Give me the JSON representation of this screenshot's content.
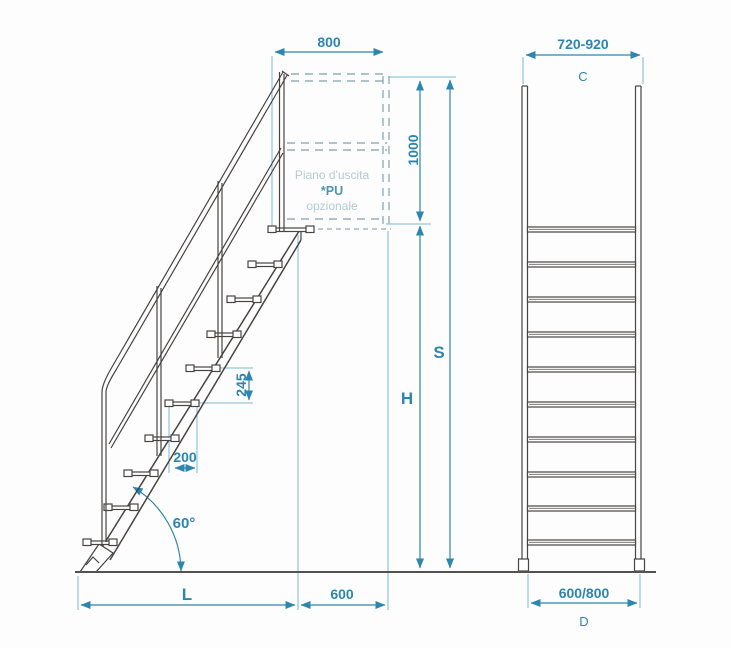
{
  "drawing": {
    "side_view": {
      "dim_platform_width": "800",
      "dim_handrail_height": "1000",
      "dim_step_rise": "245",
      "dim_tread_depth": "200",
      "dim_angle": "60°",
      "dim_run_label": "L",
      "dim_landing_depth": "600",
      "dim_total_height_label": "S",
      "dim_floor_height_label": "H",
      "note_line1": "Piano d'uscita",
      "note_line2": "*PU",
      "note_line3": "opzionale"
    },
    "front_view": {
      "dim_top_width": "720-920",
      "dim_top_width_label": "C",
      "dim_base_width": "600/800",
      "dim_base_width_label": "D"
    },
    "colors": {
      "line": "#474442",
      "dimension": "#2d86ad",
      "dashed": "#93aeb8",
      "faded_text": "#b2ccd6",
      "pu_text": "#4f94b0"
    }
  }
}
